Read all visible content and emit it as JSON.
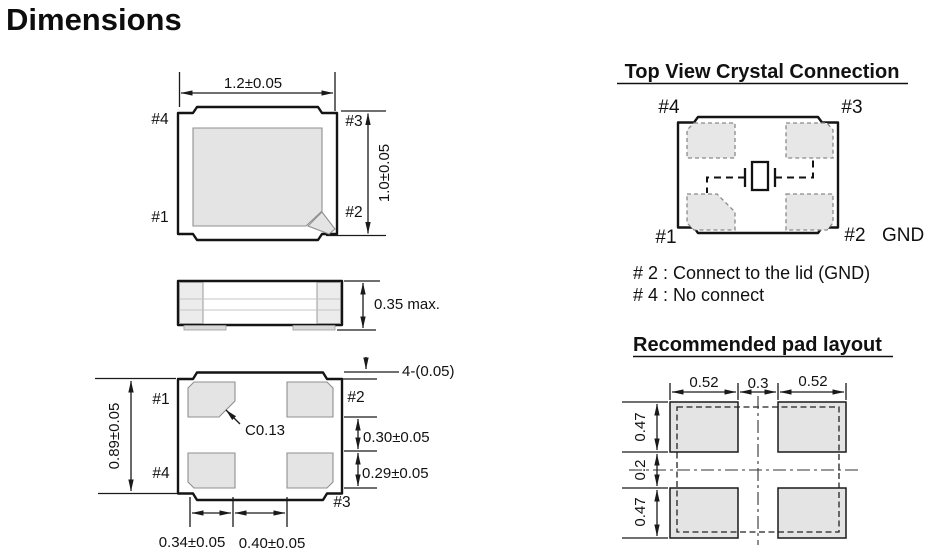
{
  "page": {
    "title": "Dimensions"
  },
  "top_view": {
    "label_tl": "#4",
    "label_tr": "#3",
    "label_bl": "#1",
    "label_br": "#2",
    "dim_width": "1.2±0.05",
    "dim_height": "1.0±0.05"
  },
  "side_view": {
    "dim_thickness": "0.35 max."
  },
  "bottom_view": {
    "label_tl": "#1",
    "label_tr": "#2",
    "label_bl": "#4",
    "label_br": "#3",
    "dim_height": "0.89±0.05",
    "corner_note": "4-(0.05)",
    "chamfer_note": "C0.13",
    "dim_right_upper": "0.30±0.05",
    "dim_right_lower": "0.29±0.05",
    "dim_bottom_left": "0.34±0.05",
    "dim_bottom_right": "0.40±0.05"
  },
  "crystal_connection": {
    "title": "Top View Crystal Connection",
    "label_tl": "#4",
    "label_tr": "#3",
    "label_bl": "#1",
    "label_br": "#2",
    "gnd_label": "GND",
    "notes": [
      "# 2 : Connect to the lid (GND)",
      "# 4 : No connect"
    ]
  },
  "pad_layout": {
    "title": "Recommended pad layout",
    "dim_top": [
      "0.52",
      "0.3",
      "0.52"
    ],
    "dim_left": [
      "0.47",
      "0.2",
      "0.47"
    ]
  },
  "colors": {
    "line": "#1a1a1a",
    "pad_fill": "#e4e4e4",
    "pad_stroke": "#8f8f8f",
    "background": "#ffffff"
  }
}
